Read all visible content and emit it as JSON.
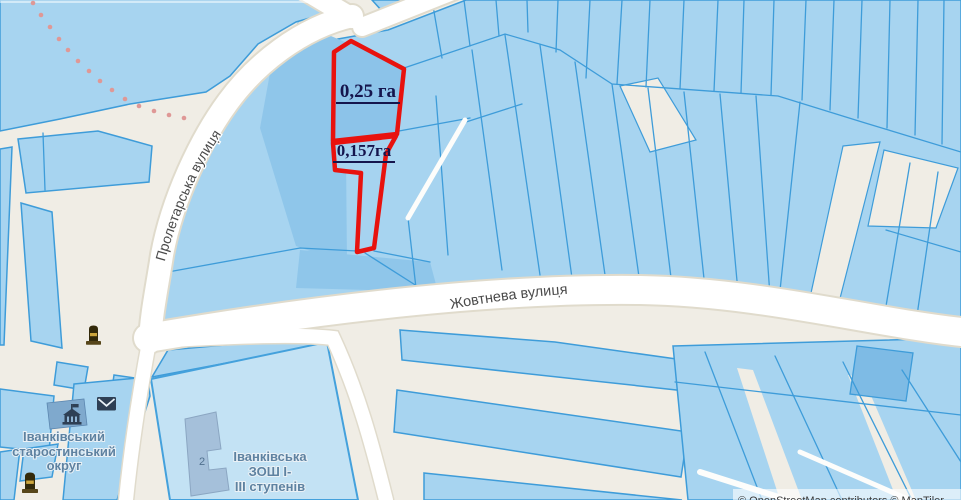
{
  "map": {
    "highlight_parcels": [
      {
        "label": "0,25 га",
        "area_ha": 0.25
      },
      {
        "label": "0,157га",
        "area_ha": 0.157
      }
    ],
    "streets": [
      {
        "name": "Пролетарська вулиця"
      },
      {
        "name": "Жовтнева вулиця"
      }
    ],
    "places": {
      "okrug_line1": "Іванківський",
      "okrug_line2": "старостинський",
      "okrug_line3": "округ",
      "school_line1": "Іванківська",
      "school_line2": "ЗОШ І-",
      "school_line3": "ІІІ ступенів",
      "school_building_number": "2"
    },
    "icons": [
      "monument-icon",
      "monument-icon",
      "townhall-icon",
      "envelope-icon"
    ],
    "attribution": "© OpenStreetMap contributors © MapTiler",
    "colors": {
      "background": "#F0EDE5",
      "parcel_fill": "#A7D4F0",
      "parcel_fill_dark": "#8FC6EA",
      "parcel_border": "#3E9CD9",
      "street_fill": "#FFFFFF",
      "highlight_outline": "#E8120E",
      "highlight_label": "#15154D",
      "place_label": "#5E82A1",
      "street_label": "#4A4A4A",
      "school_fill": "#C3E2F4",
      "building_fill": "#A5C0DA",
      "dotted_path": "#DF9896"
    }
  }
}
